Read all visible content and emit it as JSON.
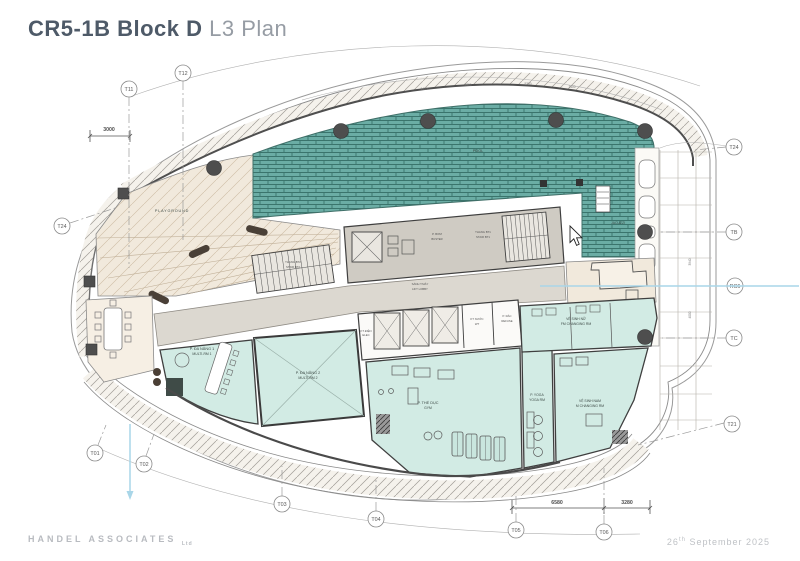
{
  "title": {
    "project": "CR5-1B Block D",
    "sheet": "L3 Plan"
  },
  "footer": {
    "firm": "HANDEL ASSOCIATES",
    "firm_suffix": "Ltd",
    "date_day": "26",
    "date_suffix": "th",
    "date_rest": " September 2025"
  },
  "colors": {
    "pool_teal": "#6badа5",
    "pool_joint": "#3a746c",
    "room_mint": "#d2ebe4",
    "terrace_beige": "#f1e9dc",
    "core_gray": "#dcd8d0",
    "wall": "#3f3f3f",
    "annotation_blue": "#a9d6e8",
    "title_dark": "#4e5a68",
    "title_light": "#969ca4"
  },
  "rooms": {
    "playground": {
      "label": "PLAYGROUND"
    },
    "pool": {
      "label": "POOL"
    },
    "jacuzzi": {
      "label": "JACUZZI"
    },
    "multi1": {
      "label_vi": "P. ĐA NĂNG 1",
      "label_en": "MULTI-RM 1"
    },
    "multi2": {
      "label_vi": "P. ĐA NĂNG 2",
      "label_en": "MULTI-RM 2"
    },
    "gym": {
      "label_vi": "P. THỂ DỤC",
      "label_en": "GYM"
    },
    "yoga": {
      "label_vi": "P. YOGA",
      "label_en": "YOGA RM"
    },
    "m_changing": {
      "label_vi": "VỆ SINH NAM",
      "label_en": "M CHANGING RM"
    },
    "f_changing": {
      "label_vi": "VỆ SINH NỮ",
      "label_en": "FM CHANGING RM"
    },
    "lift_lobby": {
      "label_vi": "SẢNH T.MÁY",
      "label_en": "LIFT LOBBY"
    },
    "stair_bt1": {
      "label_vi": "THANG BT1",
      "label_en": "STAIR BT1"
    },
    "stair_bt2": {
      "label_vi": "THANG BT2",
      "label_en": "STAIR BT2"
    },
    "pump": {
      "label_vi": "P. BƠM",
      "label_en": "BUSTER"
    },
    "elec": {
      "label_vi": "KT ĐIỆN",
      "label_en": "ELEC"
    },
    "water": {
      "label_vi": "KT NƯỚC",
      "label_en": "WT"
    },
    "refuse": {
      "label_vi": "P. RÁC",
      "label_en": "REFUSE"
    }
  },
  "grid": {
    "t11": "T11",
    "t12": "T12",
    "t24_left": "T24",
    "t24_right": "T24",
    "tb": "TB",
    "rc6": "RC6",
    "tc": "TC",
    "t21": "T21",
    "t01": "T01",
    "t02": "T02",
    "t03": "T03",
    "t04": "T04",
    "t05": "T05",
    "t06": "T06"
  },
  "dimensions": {
    "d3000": "3000",
    "d6580": "6580",
    "d3280": "3280",
    "d3940": "3940",
    "d4000": "4000",
    "d1400a": "1400",
    "d5300a": "5300",
    "d5300b": "5300",
    "d1400b": "1400"
  }
}
